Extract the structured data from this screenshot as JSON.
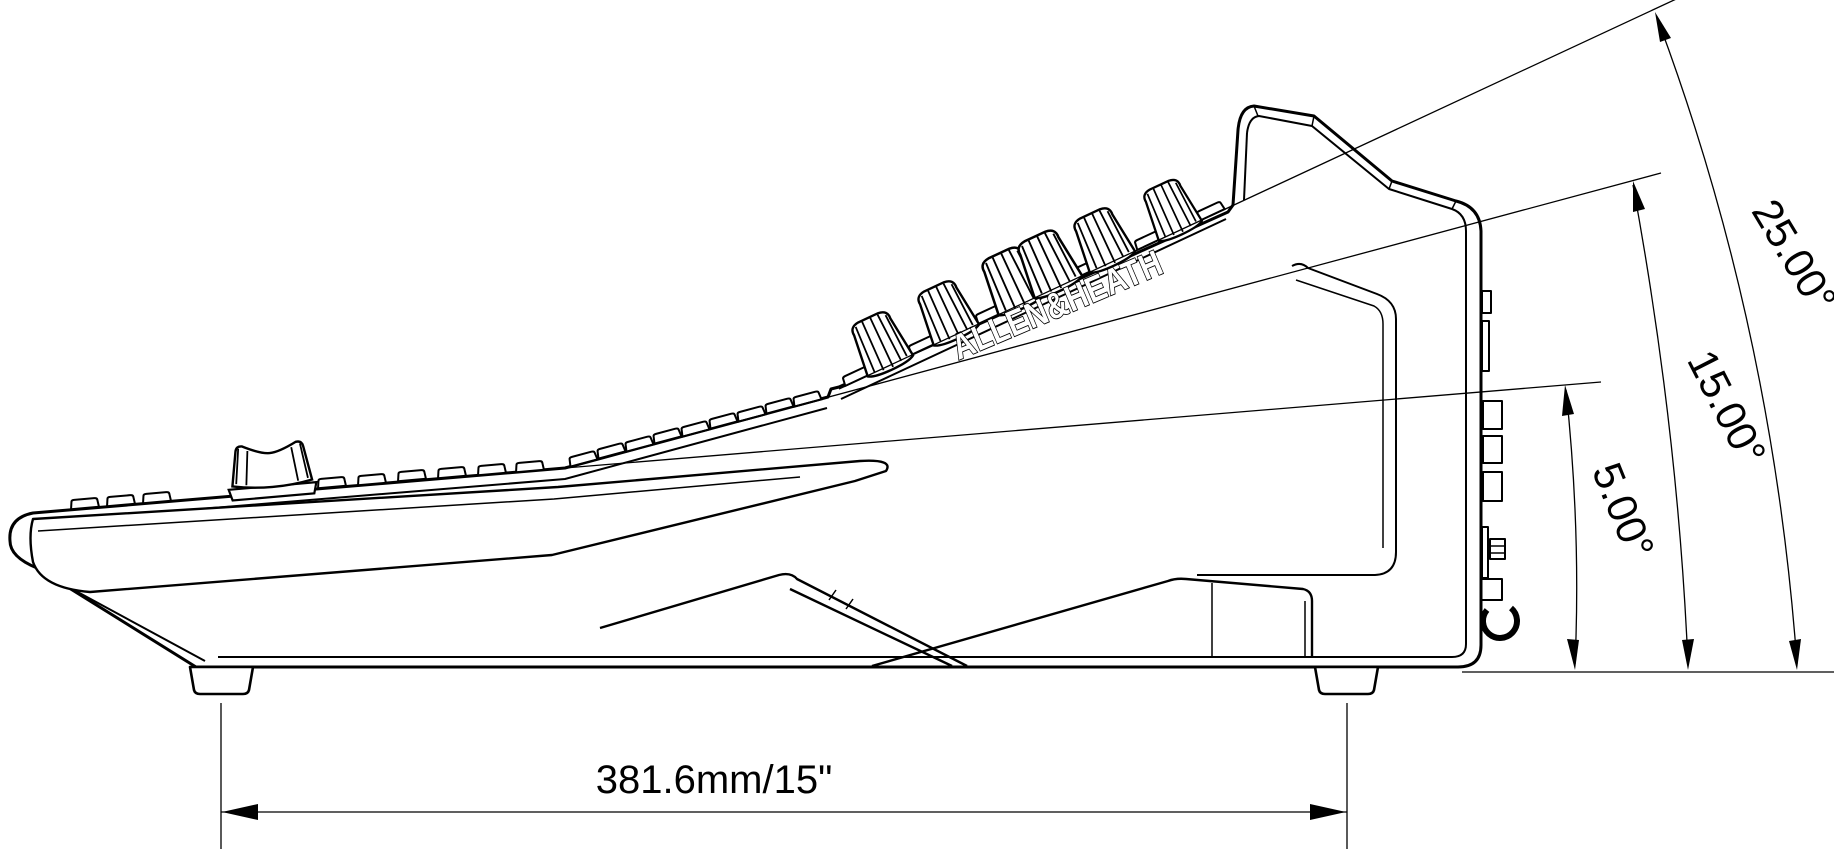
{
  "drawing": {
    "brand_label": "ALLEN&HEATH",
    "dimension_width": "381.6mm/15\"",
    "angle_labels": {
      "a25": "25.00°",
      "a15": "15.00°",
      "a5": "5.00°"
    },
    "colors": {
      "line": "#000000",
      "background": "#ffffff"
    }
  }
}
